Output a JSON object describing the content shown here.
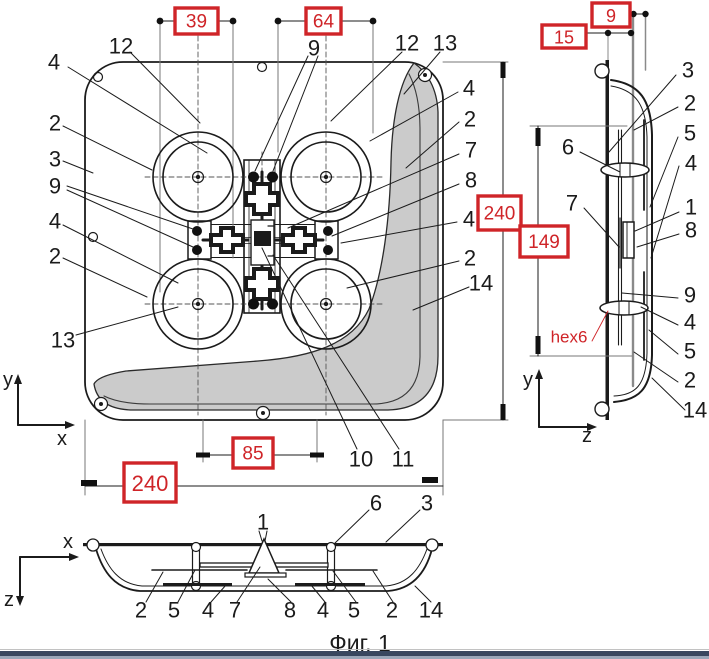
{
  "figure": {
    "caption": "Фиг. 1"
  },
  "palette": {
    "ink": "#1b1b1b",
    "red": "#cf2428",
    "shade": "#cbcbcb",
    "faint": "#8a8a8a"
  },
  "drawing": {
    "callouts": [
      {
        "t": "4",
        "x": 54,
        "y": 62
      },
      {
        "t": "12",
        "x": 121,
        "y": 46
      },
      {
        "t": "2",
        "x": 55,
        "y": 123
      },
      {
        "t": "3",
        "x": 55,
        "y": 159
      },
      {
        "t": "9",
        "x": 55,
        "y": 186
      },
      {
        "t": "4",
        "x": 55,
        "y": 221
      },
      {
        "t": "2",
        "x": 55,
        "y": 256
      },
      {
        "t": "13",
        "x": 63,
        "y": 340
      },
      {
        "t": "9",
        "x": 314,
        "y": 48
      },
      {
        "t": "12",
        "x": 407,
        "y": 43
      },
      {
        "t": "13",
        "x": 445,
        "y": 43
      },
      {
        "t": "4",
        "x": 469,
        "y": 88
      },
      {
        "t": "2",
        "x": 470,
        "y": 119
      },
      {
        "t": "7",
        "x": 471,
        "y": 150
      },
      {
        "t": "8",
        "x": 471,
        "y": 180
      },
      {
        "t": "4",
        "x": 469,
        "y": 219
      },
      {
        "t": "2",
        "x": 470,
        "y": 258
      },
      {
        "t": "14",
        "x": 481,
        "y": 283
      },
      {
        "t": "10",
        "x": 361,
        "y": 459
      },
      {
        "t": "11",
        "x": 403,
        "y": 459
      },
      {
        "t": "y",
        "x": 8,
        "y": 380,
        "fs": 20,
        "n": "front-axis-y-label"
      },
      {
        "t": "x",
        "x": 62,
        "y": 439,
        "fs": 20,
        "n": "front-axis-x-label"
      },
      {
        "t": "3",
        "x": 688,
        "y": 70
      },
      {
        "t": "2",
        "x": 690,
        "y": 103
      },
      {
        "t": "5",
        "x": 690,
        "y": 133
      },
      {
        "t": "4",
        "x": 691,
        "y": 163
      },
      {
        "t": "6",
        "x": 568,
        "y": 147
      },
      {
        "t": "7",
        "x": 572,
        "y": 203
      },
      {
        "t": "1",
        "x": 691,
        "y": 207
      },
      {
        "t": "8",
        "x": 691,
        "y": 230
      },
      {
        "t": "9",
        "x": 690,
        "y": 295
      },
      {
        "t": "4",
        "x": 690,
        "y": 322
      },
      {
        "t": "5",
        "x": 690,
        "y": 351
      },
      {
        "t": "2",
        "x": 690,
        "y": 380
      },
      {
        "t": "14",
        "x": 695,
        "y": 410
      },
      {
        "t": "hex6",
        "x": 569,
        "y": 337,
        "fs": 17,
        "color": "#cf2428",
        "n": "hex6-annotation"
      },
      {
        "t": "y",
        "x": 528,
        "y": 380,
        "fs": 20,
        "n": "side-axis-y-label"
      },
      {
        "t": "z",
        "x": 587,
        "y": 436,
        "fs": 20,
        "n": "side-axis-z-label"
      },
      {
        "t": "1",
        "x": 263,
        "y": 522
      },
      {
        "t": "6",
        "x": 376,
        "y": 503
      },
      {
        "t": "3",
        "x": 427,
        "y": 503
      },
      {
        "t": "2",
        "x": 141,
        "y": 610
      },
      {
        "t": "5",
        "x": 174,
        "y": 610
      },
      {
        "t": "4",
        "x": 208,
        "y": 610
      },
      {
        "t": "7",
        "x": 235,
        "y": 610
      },
      {
        "t": "8",
        "x": 290,
        "y": 610
      },
      {
        "t": "4",
        "x": 323,
        "y": 610
      },
      {
        "t": "5",
        "x": 354,
        "y": 610
      },
      {
        "t": "2",
        "x": 392,
        "y": 610
      },
      {
        "t": "14",
        "x": 431,
        "y": 610
      },
      {
        "t": "x",
        "x": 68,
        "y": 542,
        "fs": 20,
        "n": "bottom-axis-x-label"
      },
      {
        "t": "z",
        "x": 9,
        "y": 600,
        "fs": 20,
        "n": "bottom-axis-z-label"
      }
    ],
    "dimension_boxes": [
      {
        "t": "39",
        "x": 175,
        "y": 8,
        "w": 43,
        "h": 26
      },
      {
        "t": "64",
        "x": 306,
        "y": 8,
        "w": 35,
        "h": 26
      },
      {
        "t": "9",
        "x": 592,
        "y": 3,
        "w": 38,
        "h": 24,
        "fs": 18
      },
      {
        "t": "15",
        "x": 542,
        "y": 25,
        "w": 44,
        "h": 23,
        "fs": 18
      },
      {
        "t": "240",
        "x": 478,
        "y": 196,
        "w": 43,
        "h": 34
      },
      {
        "t": "149",
        "x": 520,
        "y": 226,
        "w": 48,
        "h": 31
      },
      {
        "t": "85",
        "x": 233,
        "y": 438,
        "w": 40,
        "h": 30
      },
      {
        "t": "240",
        "x": 124,
        "y": 463,
        "w": 52,
        "h": 39,
        "fs": 22
      }
    ]
  }
}
